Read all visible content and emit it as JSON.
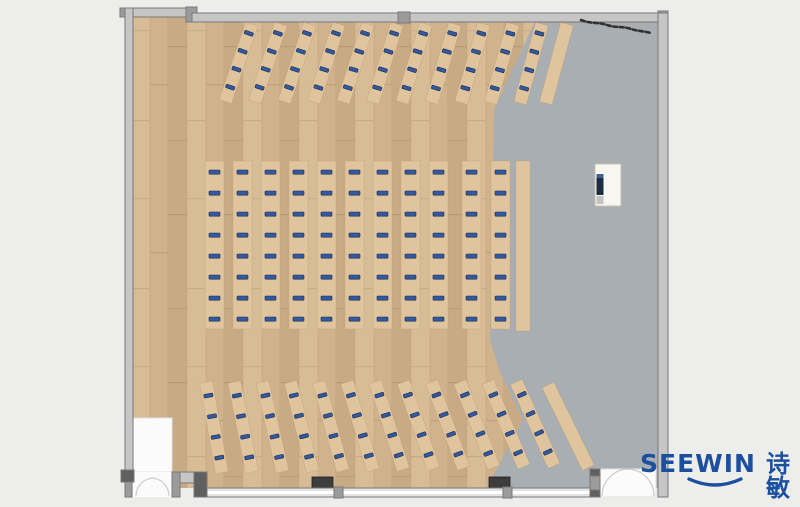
{
  "meta": {
    "view": "floor-plan-top-view-render",
    "scene": "training room / classroom furniture layout"
  },
  "palette": {
    "page_bg": "#ededec",
    "wood_floor": "#d0b28c",
    "wood_plank_light": "#d7bc96",
    "wood_plank_dark": "#c8aa84",
    "gray_floor": "#a8aeb1",
    "wall_fill": "#c6c6c6",
    "wall_edge": "#787878",
    "wall_cap": "#9b9b9b",
    "wall_cap_dark": "#606060",
    "window_white": "#ffffff",
    "desk_fill": "#dfc49e",
    "desk_edge": "#b69365",
    "seat_fill": "#35599f",
    "seat_edge": "#132a52",
    "door_white": "#fbfbfb",
    "door_arc": "#cccccc",
    "dark_box": "#3d3d3d",
    "podium_body": "#f7f6f1",
    "podium_edge": "#c9c1b0",
    "podium_screen": "#1d2c41",
    "scribble": "#232323",
    "logo_blue": "#1b509f"
  },
  "furniture": {
    "top_section": {
      "desk_count": 11,
      "seats_per_desk": 4,
      "start_x": 252,
      "spacing_x": 29,
      "top_y": 24,
      "desk_length": 82,
      "desk_width": 13,
      "angle_first": 19,
      "angle_step": -0.35,
      "seat_offsets": [
        8,
        27,
        46,
        65
      ],
      "plain_desk": {
        "x": 567,
        "angle": 15
      }
    },
    "middle_section": {
      "column_x": [
        205,
        233,
        261,
        289,
        317,
        345,
        373,
        401,
        429,
        462,
        491
      ],
      "seats_per_column": 8,
      "y": 161,
      "height": 168,
      "width": 19,
      "seat_start": 9,
      "seat_pitch": 21,
      "plain_desk": {
        "x": 516,
        "y": 161,
        "width": 14,
        "height": 170
      }
    },
    "bottom_section": {
      "desk_count": 12,
      "seats_per_desk": 4,
      "start_x": 206,
      "spacing_x": 28.2,
      "top_y": 382,
      "desk_length": 92,
      "desk_width": 13,
      "angle_first": -10,
      "angle_step": -1.3,
      "seat_offsets": [
        12,
        33,
        54,
        75
      ],
      "plain_desk": {
        "x": 548,
        "angle": -26
      }
    },
    "podium": {
      "x": 595,
      "y": 164,
      "width": 26,
      "height": 42
    }
  },
  "logo": {
    "brand": "SEEWIN",
    "suffix": "诗敏"
  }
}
